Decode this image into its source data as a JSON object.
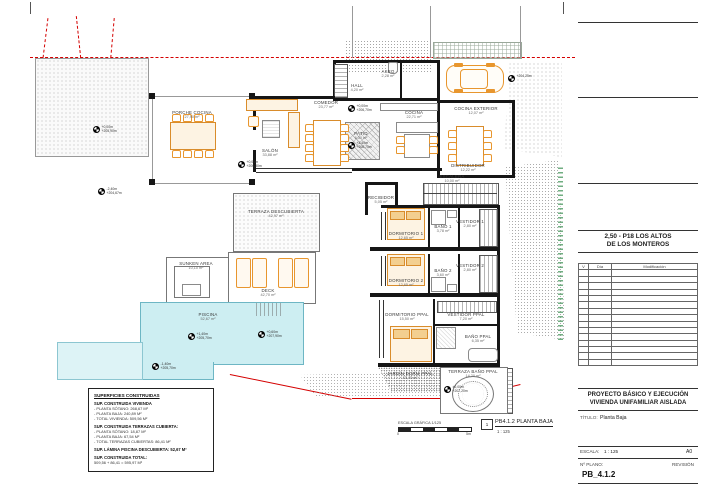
{
  "colors": {
    "furniture": "#e8962e",
    "pool": "#cdeef2",
    "boundary_red": "#d40000",
    "wall": "#161616"
  },
  "plan": {
    "rooms": {
      "porche_cocina": {
        "name": "PORCHE COCINA",
        "area": "27,90 m²"
      },
      "salon": {
        "name": "SALÓN",
        "area": "33,88 m²"
      },
      "comedor": {
        "name": "COMEDOR",
        "area": "23,77 m²"
      },
      "hall": {
        "name": "HALL",
        "area": "4,20 m²"
      },
      "aseo": {
        "name": "ASEO",
        "area": "2,28 m²"
      },
      "cocina": {
        "name": "COCINA",
        "area": "22,71 m²"
      },
      "patio": {
        "name": "PATIO",
        "area": "6,30 m²"
      },
      "cocina_exterior": {
        "name": "COCINA EXTERIOR",
        "area": "12,07 m²"
      },
      "distribuidor": {
        "name": "DISTRIBUIDOR",
        "area": "12,22 m²"
      },
      "escalera": {
        "name": "ESCALERA",
        "area": "10,00 m²"
      },
      "recibidor": {
        "name": "RECIBIDOR",
        "area": "5,05 m²"
      },
      "dormitorio_1": {
        "name": "DORMITORIO 1",
        "area": "12,65 m²"
      },
      "bano_1": {
        "name": "BAÑO 1",
        "area": "3,78 m²"
      },
      "vestidor_1": {
        "name": "VESTIDOR 1",
        "area": "2,80 m²"
      },
      "dormitorio_2": {
        "name": "DORMITORIO 2",
        "area": "12,65 m²"
      },
      "bano_2": {
        "name": "BAÑO 2",
        "area": "3,60 m²"
      },
      "vestidor_2": {
        "name": "VESTIDOR 2",
        "area": "2,80 m²"
      },
      "dormitorio_ppal": {
        "name": "DORMITORIO PPAL",
        "area": "15,50 m²"
      },
      "vestidor_ppal": {
        "name": "VESTIDOR PPAL",
        "area": "7,20 m²"
      },
      "bano_ppal": {
        "name": "BAÑO PPAL",
        "area": "6,35 m²"
      },
      "jardin_dorm_ppal": {
        "name": "JARDÍN DORM PPAL",
        "area": "13,40 m²"
      },
      "terraza_bano_ppal": {
        "name": "TERRAZA BAÑO PPAL",
        "area": "14,20 m²"
      },
      "terraza_descubierta": {
        "name": "TERRAZA DESCUBIERTA",
        "area": "42,97 m²"
      },
      "deck": {
        "name": "DECK",
        "area": "42,70 m²"
      },
      "sunken_area": {
        "name": "SUNKEN AREA",
        "area": "10,10 m²"
      },
      "piscina": {
        "name": "PISCINA",
        "area": "52,67 m²"
      }
    },
    "markers": {
      "m1": {
        "l1": "+0,00m",
        "l2": "+205,90m"
      },
      "m2": {
        "l1": "-2,40m",
        "l2": "+204,67m"
      },
      "m3": {
        "l1": "+0,00m",
        "l2": "+206,70m"
      },
      "m4": {
        "l1": "+1,40m",
        "l2": "+206,70m"
      },
      "m5": {
        "l1": "+1,40m",
        "l2": "+205,70m"
      },
      "m6": {
        "l1": "+0,60m",
        "l2": "+207,90m"
      },
      "m7": {
        "l1": "-1,40m",
        "l2": "+205,70m"
      },
      "m8": {
        "l1": "+204,25m",
        "l2": ""
      },
      "m9": {
        "l1": "+0,00m",
        "l2": "+206,30m"
      },
      "m10": {
        "l1": "±0,00m",
        "l2": "+207,20m"
      }
    },
    "scale_bar": {
      "label": "ESCALA GRÁFICA 1/125",
      "start": "0",
      "end": "5m"
    },
    "callout": {
      "number": "1",
      "title": "PB4.1.2 PLANTA BAJA",
      "scale": "1 : 125"
    }
  },
  "areas_box": {
    "title": "SUPERFICIES CONSTRUIDAS",
    "vivienda_header": "SUP. CONSTRUIDA VIVIENDA",
    "vivienda_lines": [
      "- PLANTA SÓTANO: 268,67 M²",
      "- PLANTA BAJA: 240,89 M²",
      "- TOTAL VIVIENDA: 509,56 M²"
    ],
    "terrazas_header": "SUP. CONSTRUIDA TERRAZAS CUBIERTA:",
    "terrazas_lines": [
      "- PLANTA SÓTANO: 18,87 M²",
      "- PLANTA BAJA: 67,54 M²",
      "- TOTAL TERRAZAS CUBIERTAS: 86,41 M²"
    ],
    "piscina_line": "SUP. LÁMINA PISCINA DESCUBIERTA: 52,67 M²",
    "total_header": "SUP. CONSTRUIDA TOTAL:",
    "total_line": "509,56 + 86,41 = 595,97 M²"
  },
  "title_block": {
    "project_code_line1": "2,50 - P18 LOS ALTOS",
    "project_code_line2": "DE LOS MONTEROS",
    "rev_col_v": "V",
    "rev_col_dia": "Día",
    "rev_col_mod": "Modificación",
    "project_title_line1": "PROYECTO BÁSICO Y EJECUCIÓN",
    "project_title_line2": "VIVIENDA UNIFAMILIAR AISLADA",
    "titulo_label": "TÍTULO:",
    "titulo_value": "Planta Baja",
    "escala_label": "ESCALA:",
    "escala_value": "1 : 125",
    "paper_size": "A0",
    "num_plano_label": "Nº PLANO:",
    "revision_label": "REVISIÓN",
    "plano_number": "PB_4.1.2"
  }
}
